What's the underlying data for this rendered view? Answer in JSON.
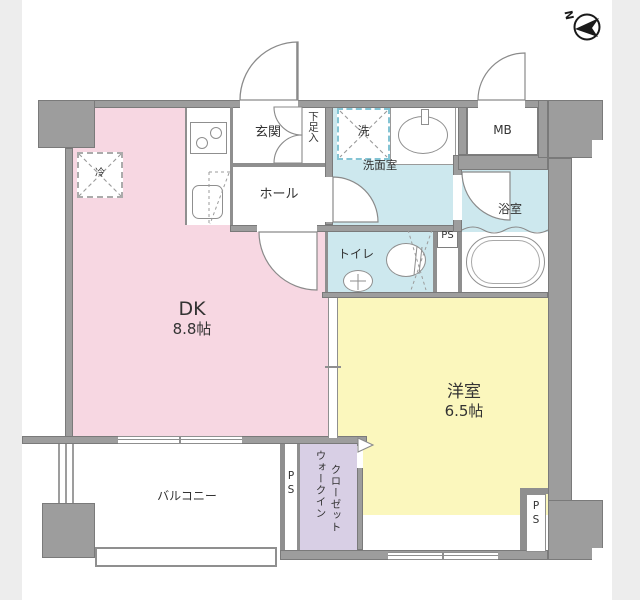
{
  "compass": {
    "north_label": "N"
  },
  "rooms": {
    "dk": {
      "name": "DK",
      "size": "8.8帖"
    },
    "western": {
      "name": "洋室",
      "size": "6.5帖"
    },
    "balcony": {
      "name": "バルコニー"
    },
    "wic": {
      "line1": "ウォークイン",
      "line2": "クローゼット"
    },
    "genkan": {
      "name": "玄関"
    },
    "shoe_box": {
      "name": "下足入"
    },
    "hall": {
      "name": "ホール"
    },
    "washroom": {
      "name": "洗面室"
    },
    "washer": {
      "name": "洗"
    },
    "bath": {
      "name": "浴室"
    },
    "toilet": {
      "name": "トイレ"
    },
    "meter_box": {
      "name": "MB"
    },
    "fridge": {
      "name": "冷"
    }
  },
  "labels": {
    "ps_toilet": "PS",
    "ps_balcony": "PS",
    "ps_corner": "PS"
  },
  "colors": {
    "dk_floor": "#f7d7e2",
    "western_floor": "#fbf7bd",
    "wet_area_floor": "#cde8ee",
    "closet_floor": "#d8cfe5",
    "wall": "#9d9d9d",
    "page_margin": "#ededed",
    "line": "#8a8a8a",
    "text": "#333333"
  }
}
